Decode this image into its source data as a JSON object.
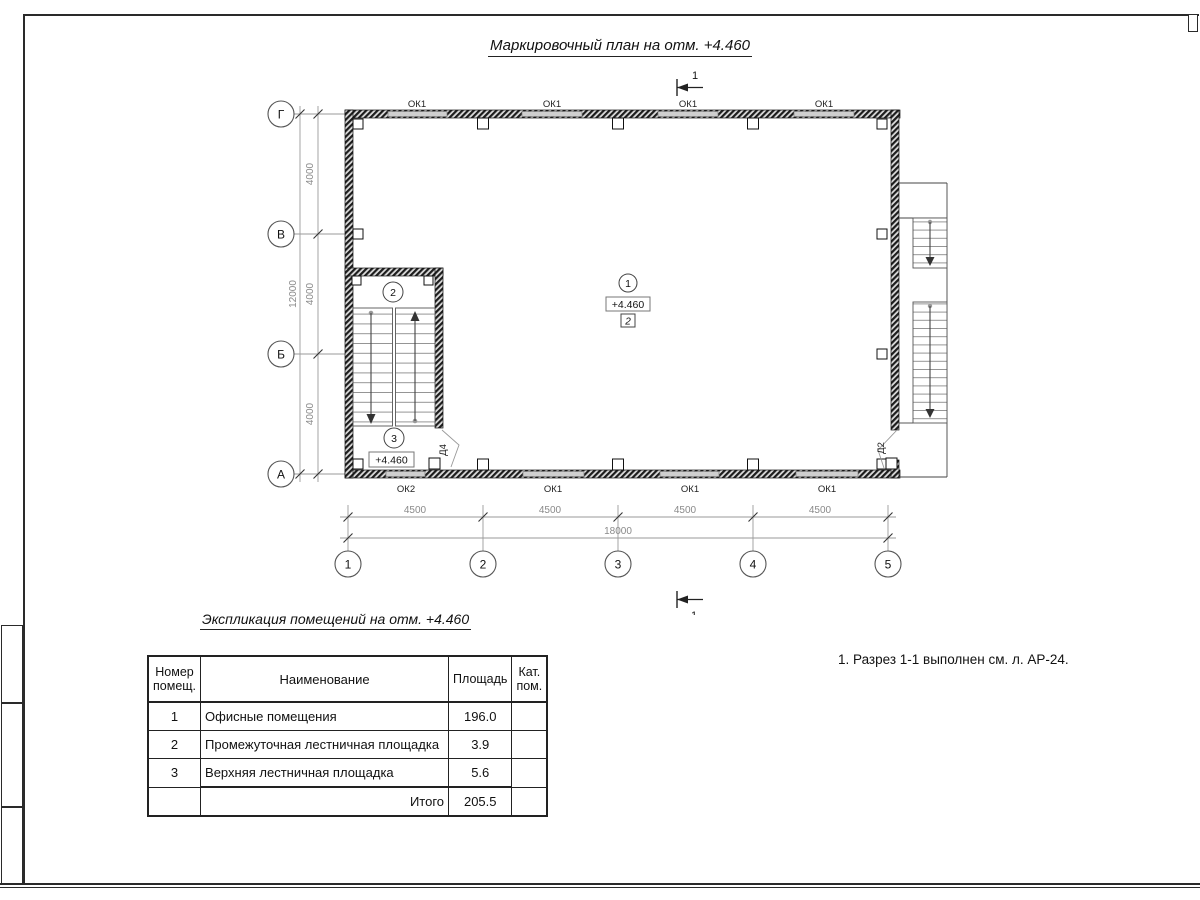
{
  "sheet": {
    "title": "Маркировочный план на отм. +4.460",
    "note": "1. Разрез 1-1 выполнен см. л. АР-24."
  },
  "plan": {
    "axes_rows": [
      "Г",
      "В",
      "Б",
      "А"
    ],
    "axes_cols": [
      "1",
      "2",
      "3",
      "4",
      "5"
    ],
    "dim_v": [
      "4000",
      "4000",
      "4000"
    ],
    "dim_v_total": "12000",
    "dim_h": [
      "4500",
      "4500",
      "4500",
      "4500"
    ],
    "dim_h_total": "18000",
    "win_top": [
      "ОК1",
      "ОК1",
      "ОК1",
      "ОК1"
    ],
    "win_bottom": [
      "ОК2",
      "ОК1",
      "ОК1",
      "ОК1"
    ],
    "door_left": "Д4",
    "door_right": "Д2",
    "section": "1",
    "room1": {
      "num": "1",
      "elev": "+4.460",
      "floor_type": "2"
    },
    "room2": {
      "num": "2"
    },
    "room3": {
      "num": "3",
      "elev": "+4.460"
    }
  },
  "table": {
    "title": "Экспликация помещений на отм. +4.460",
    "header": {
      "num1": "Номер",
      "num2": "помещ.",
      "name": "Наименование",
      "area": "Площадь",
      "cat1": "Кат.",
      "cat2": "пом."
    },
    "rows": [
      {
        "num": "1",
        "name": "Офисные помещения",
        "area": "196.0",
        "cat": ""
      },
      {
        "num": "2",
        "name": "Промежуточная лестничная площадка",
        "area": "3.9",
        "cat": ""
      },
      {
        "num": "3",
        "name": "Верхняя лестничная площадка",
        "area": "5.6",
        "cat": ""
      }
    ],
    "total_label": "Итого",
    "total_value": "205.5"
  }
}
